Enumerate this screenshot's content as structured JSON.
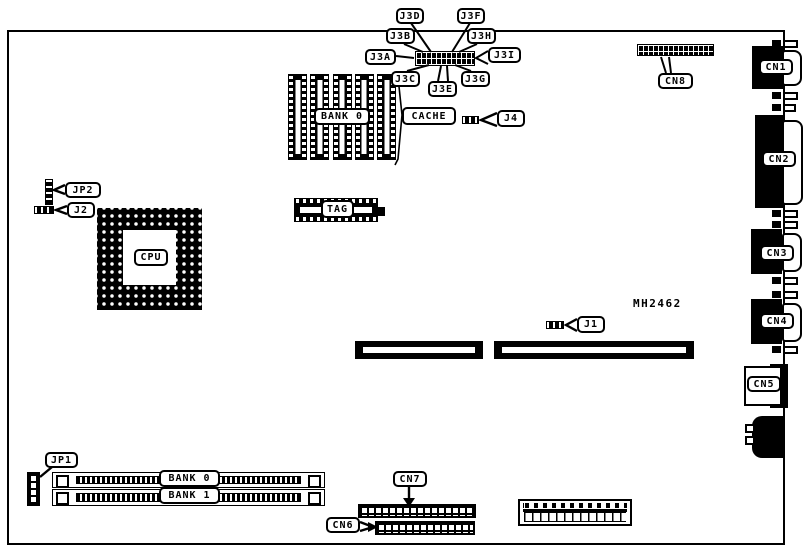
{
  "board": {
    "part_number": "MH2462",
    "jumpers": {
      "j3a": "J3A",
      "j3b": "J3B",
      "j3c": "J3C",
      "j3d": "J3D",
      "j3e": "J3E",
      "j3f": "J3F",
      "j3g": "J3G",
      "j3h": "J3H",
      "j3i": "J3I",
      "j1": "J1",
      "j2": "J2",
      "j4": "J4",
      "jp1": "JP1",
      "jp2": "JP2"
    },
    "connectors": {
      "cn1": "CN1",
      "cn2": "CN2",
      "cn3": "CN3",
      "cn4": "CN4",
      "cn5": "CN5",
      "cn6": "CN6",
      "cn7": "CN7",
      "cn8": "CN8"
    },
    "components": {
      "cpu": "CPU",
      "tag": "TAG",
      "cache": "CACHE",
      "cache_bank": "BANK 0",
      "memory_bank_0": "BANK 0",
      "memory_bank_1": "BANK 1"
    }
  }
}
